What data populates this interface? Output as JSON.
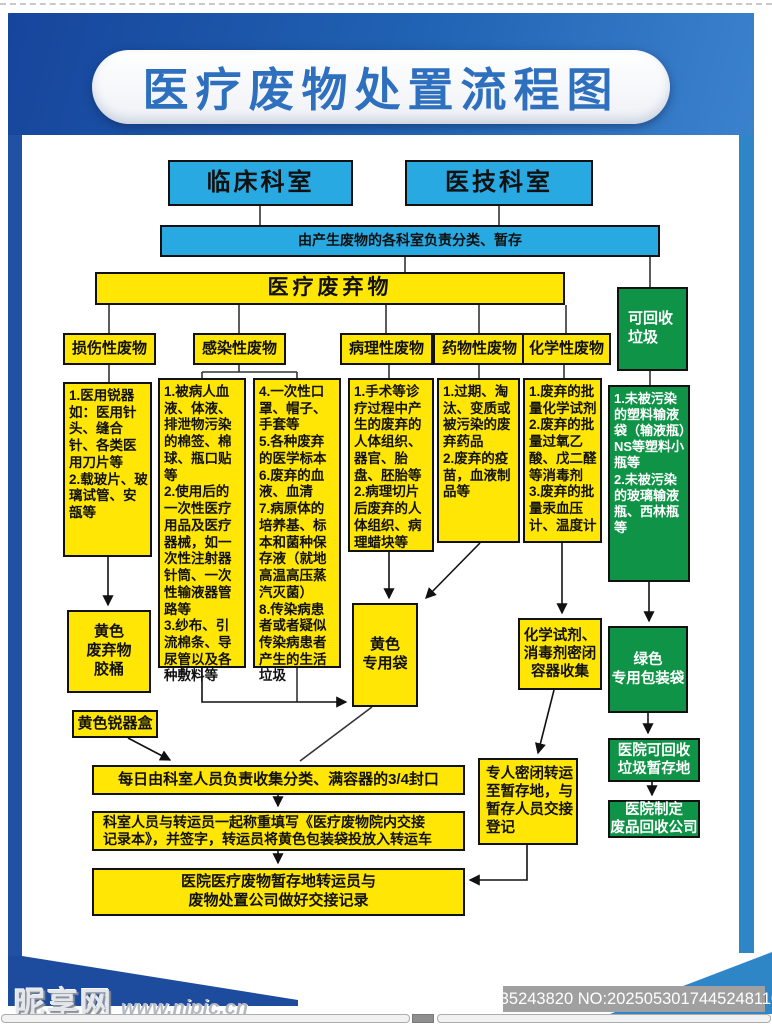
{
  "header": {
    "title": "医疗废物处置流程图"
  },
  "flow": {
    "clinical": "临床科室",
    "tech": "医技科室",
    "classify": "由产生废物的各科室负责分类、暂存",
    "waste": "医疗废弃物",
    "categories": [
      "损伤性废物",
      "感染性废物",
      "病理性废物",
      "药物性废物",
      "化学性废物"
    ],
    "recyclable": "可回收\n垃圾",
    "details": [
      "1.医用锐器如：医用针头、缝合针、各类医用刀片等\n2.载玻片、玻璃试管、安瓿等",
      "1.被病人血液、体液、排泄物污染的棉签、棉球、瓶口贴等\n2.使用后的一次性医疗用品及医疗器械，如一次性注射器针筒、一次性输液器管路等\n3.纱布、引流棉条、导尿管以及各种敷料等",
      "4.一次性口罩、帽子、手套等\n5.各种废弃的医学标本\n6.废弃的血液、血清\n7.病原体的培养基、标本和菌种保存液（就地高温高压蒸汽灭菌）\n8.传染病患者或者疑似传染病患者产生的生活垃圾",
      "1.手术等诊疗过程中产生的废弃的人体组织、器官、胎盘、胚胎等\n2.病理切片后废弃的人体组织、病理蜡块等",
      "1.过期、淘汰、变质或被污染的废弃药品\n2.废弃的疫苗，血液制品等",
      "1.废弃的批量化学试剂\n2.废弃的批量过氧乙酸、戊二醛等消毒剂\n3.废弃的批量汞血压计、温度计"
    ],
    "recyclable_detail": "1.未被污染的塑料输液袋（输液瓶）NS等塑料小瓶等\n2.未被污染的玻璃输液瓶、西林瓶等",
    "containers": {
      "bucket": "黄色\n废弃物\n胶桶",
      "sharps": "黄色锐器盒",
      "bag": "黄色\n专用袋",
      "chem": "化学试剂、\n消毒剂密闭\n容器收集",
      "green_bag": "绿色\n专用包装袋",
      "green_storage": "医院可回收\n垃圾暂存地",
      "green_company": "医院制定\n废品回收公司"
    },
    "process": {
      "collect": "每日由科室人员负责收集分类、满容器的3/4封口",
      "transfer": "专人密闭转运\n至暂存地，与\n暂存人员交接\n登记",
      "weigh": "科室人员与转运员一起称重填写《医疗废物院内交接\n记录本》，并签字，转运员将黄色包装袋投放入转运车",
      "handover": "医院医疗废物暂存地转运员与\n废物处置公司做好交接记录"
    }
  },
  "footer": {
    "site": "昵享网",
    "url": "www.nipic.cn",
    "id": "ID:35243820 NO:20250530174452481101"
  },
  "colors": {
    "blue_box": "#29a9e1",
    "yellow": "#ffe604",
    "green": "#0f9347",
    "header_dark": "#16459c",
    "header_light": "#3b82cd"
  }
}
